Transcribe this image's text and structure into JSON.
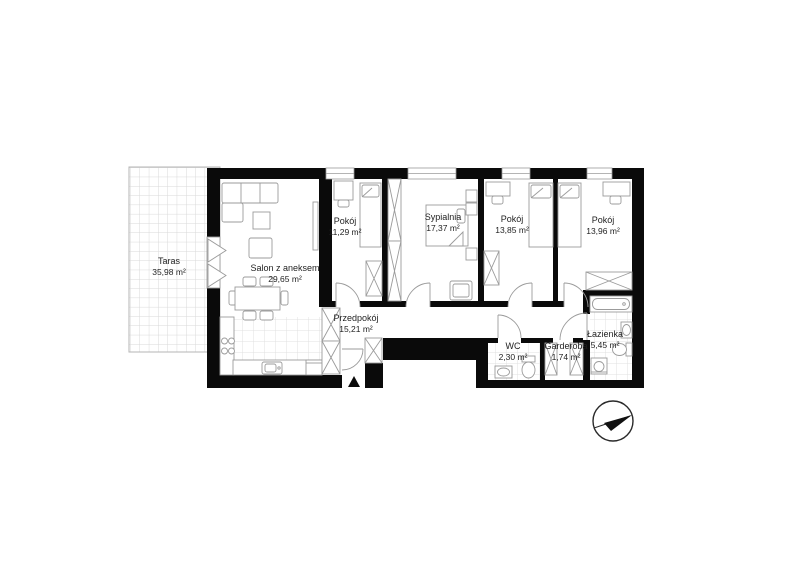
{
  "plan": {
    "type": "apartment-floor-plan",
    "rooms": [
      {
        "id": "taras",
        "name": "Taras",
        "area": "35,98 m²"
      },
      {
        "id": "salon",
        "name": "Salon z aneksem",
        "area": "29,65 m²"
      },
      {
        "id": "pokoj-1",
        "name": "Pokój",
        "area": "11,29 m²"
      },
      {
        "id": "sypialnia",
        "name": "Sypialnia",
        "area": "17,37 m²"
      },
      {
        "id": "pokoj-2",
        "name": "Pokój",
        "area": "13,85 m²"
      },
      {
        "id": "pokoj-3",
        "name": "Pokój",
        "area": "13,96 m²"
      },
      {
        "id": "przedpokoj",
        "name": "Przedpokój",
        "area": "15,21 m²"
      },
      {
        "id": "wc",
        "name": "WC",
        "area": "2,30 m²"
      },
      {
        "id": "garderoba",
        "name": "Garderoba",
        "area": "1,74 m²"
      },
      {
        "id": "lazienka",
        "name": "Łazienka",
        "area": "5,45 m²"
      }
    ],
    "icons": {
      "compass": "north-arrow-compass",
      "entrance": "entrance-triangle-marker",
      "balcony_door": "double-triangle-opening-symbol"
    },
    "colors": {
      "wall": "#0a0a0a",
      "furniture_line": "#9b9b9b",
      "tile_line": "#dfdfdf",
      "terrace_tile_line": "#d9d9d9",
      "text": "#1f1f1f"
    }
  }
}
